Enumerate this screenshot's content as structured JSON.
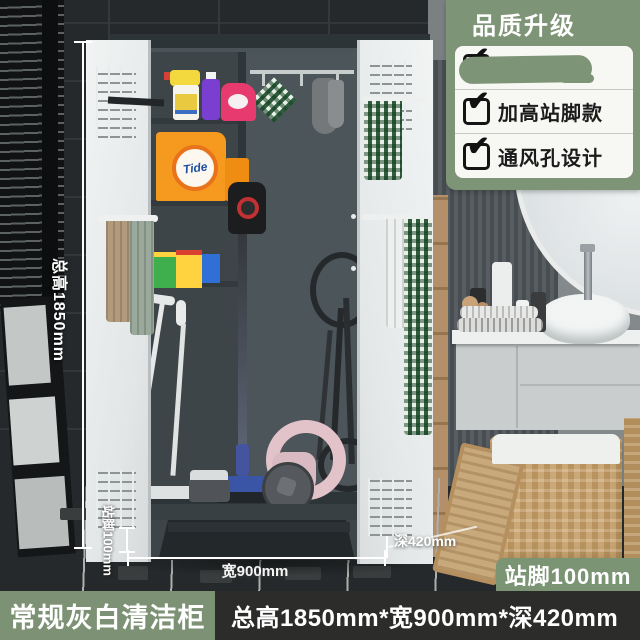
{
  "promo_panel": {
    "title": "品质升级",
    "features": [
      {
        "label": "",
        "redacted": true
      },
      {
        "label": "加高站脚款",
        "redacted": false
      },
      {
        "label": "通风孔设计",
        "redacted": false
      }
    ]
  },
  "icons": {
    "check": "✔"
  },
  "annotations": {
    "total_height": "总高1850mm",
    "leg_height_vertical": "站脚100mm",
    "width": "宽900mm",
    "depth": "深420mm",
    "leg_badge": "站脚100mm"
  },
  "products": {
    "detergent_brand": "Tide"
  },
  "bottom_bar": {
    "product_name": "常规灰白清洁柜",
    "spec": "总高1850mm*宽900mm*深420mm"
  },
  "colors": {
    "accent_green": "#7E9476",
    "bar_dark": "#2C2C2A",
    "cabinet_dark": "#3E464B",
    "door_white": "#E9ECEC",
    "annotation_white": "#FFFFFF"
  }
}
